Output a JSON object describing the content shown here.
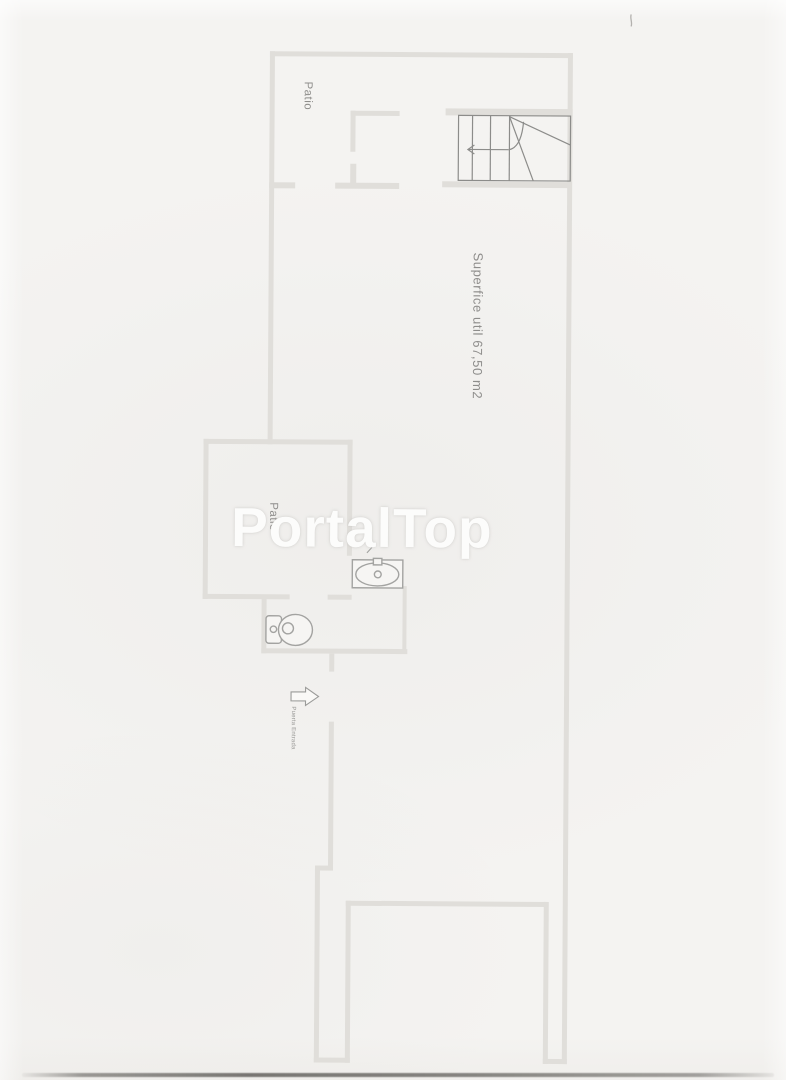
{
  "watermark": {
    "text": "PortalTop"
  },
  "plan": {
    "labels": {
      "patio_top": "Patio",
      "surface": "Superfice util 67,50 m2",
      "patio_middle": "Patio",
      "entrance_door": "Puerta Entrada"
    }
  },
  "colors": {
    "paper": "#f4f3f1",
    "wall": "#e0deda",
    "stair_line": "#8c8c8a",
    "fixture_line": "#a3a3a1",
    "label_text": "#8e8d8b",
    "watermark": "#fcfcfb",
    "scan_edge": "#55534f"
  }
}
